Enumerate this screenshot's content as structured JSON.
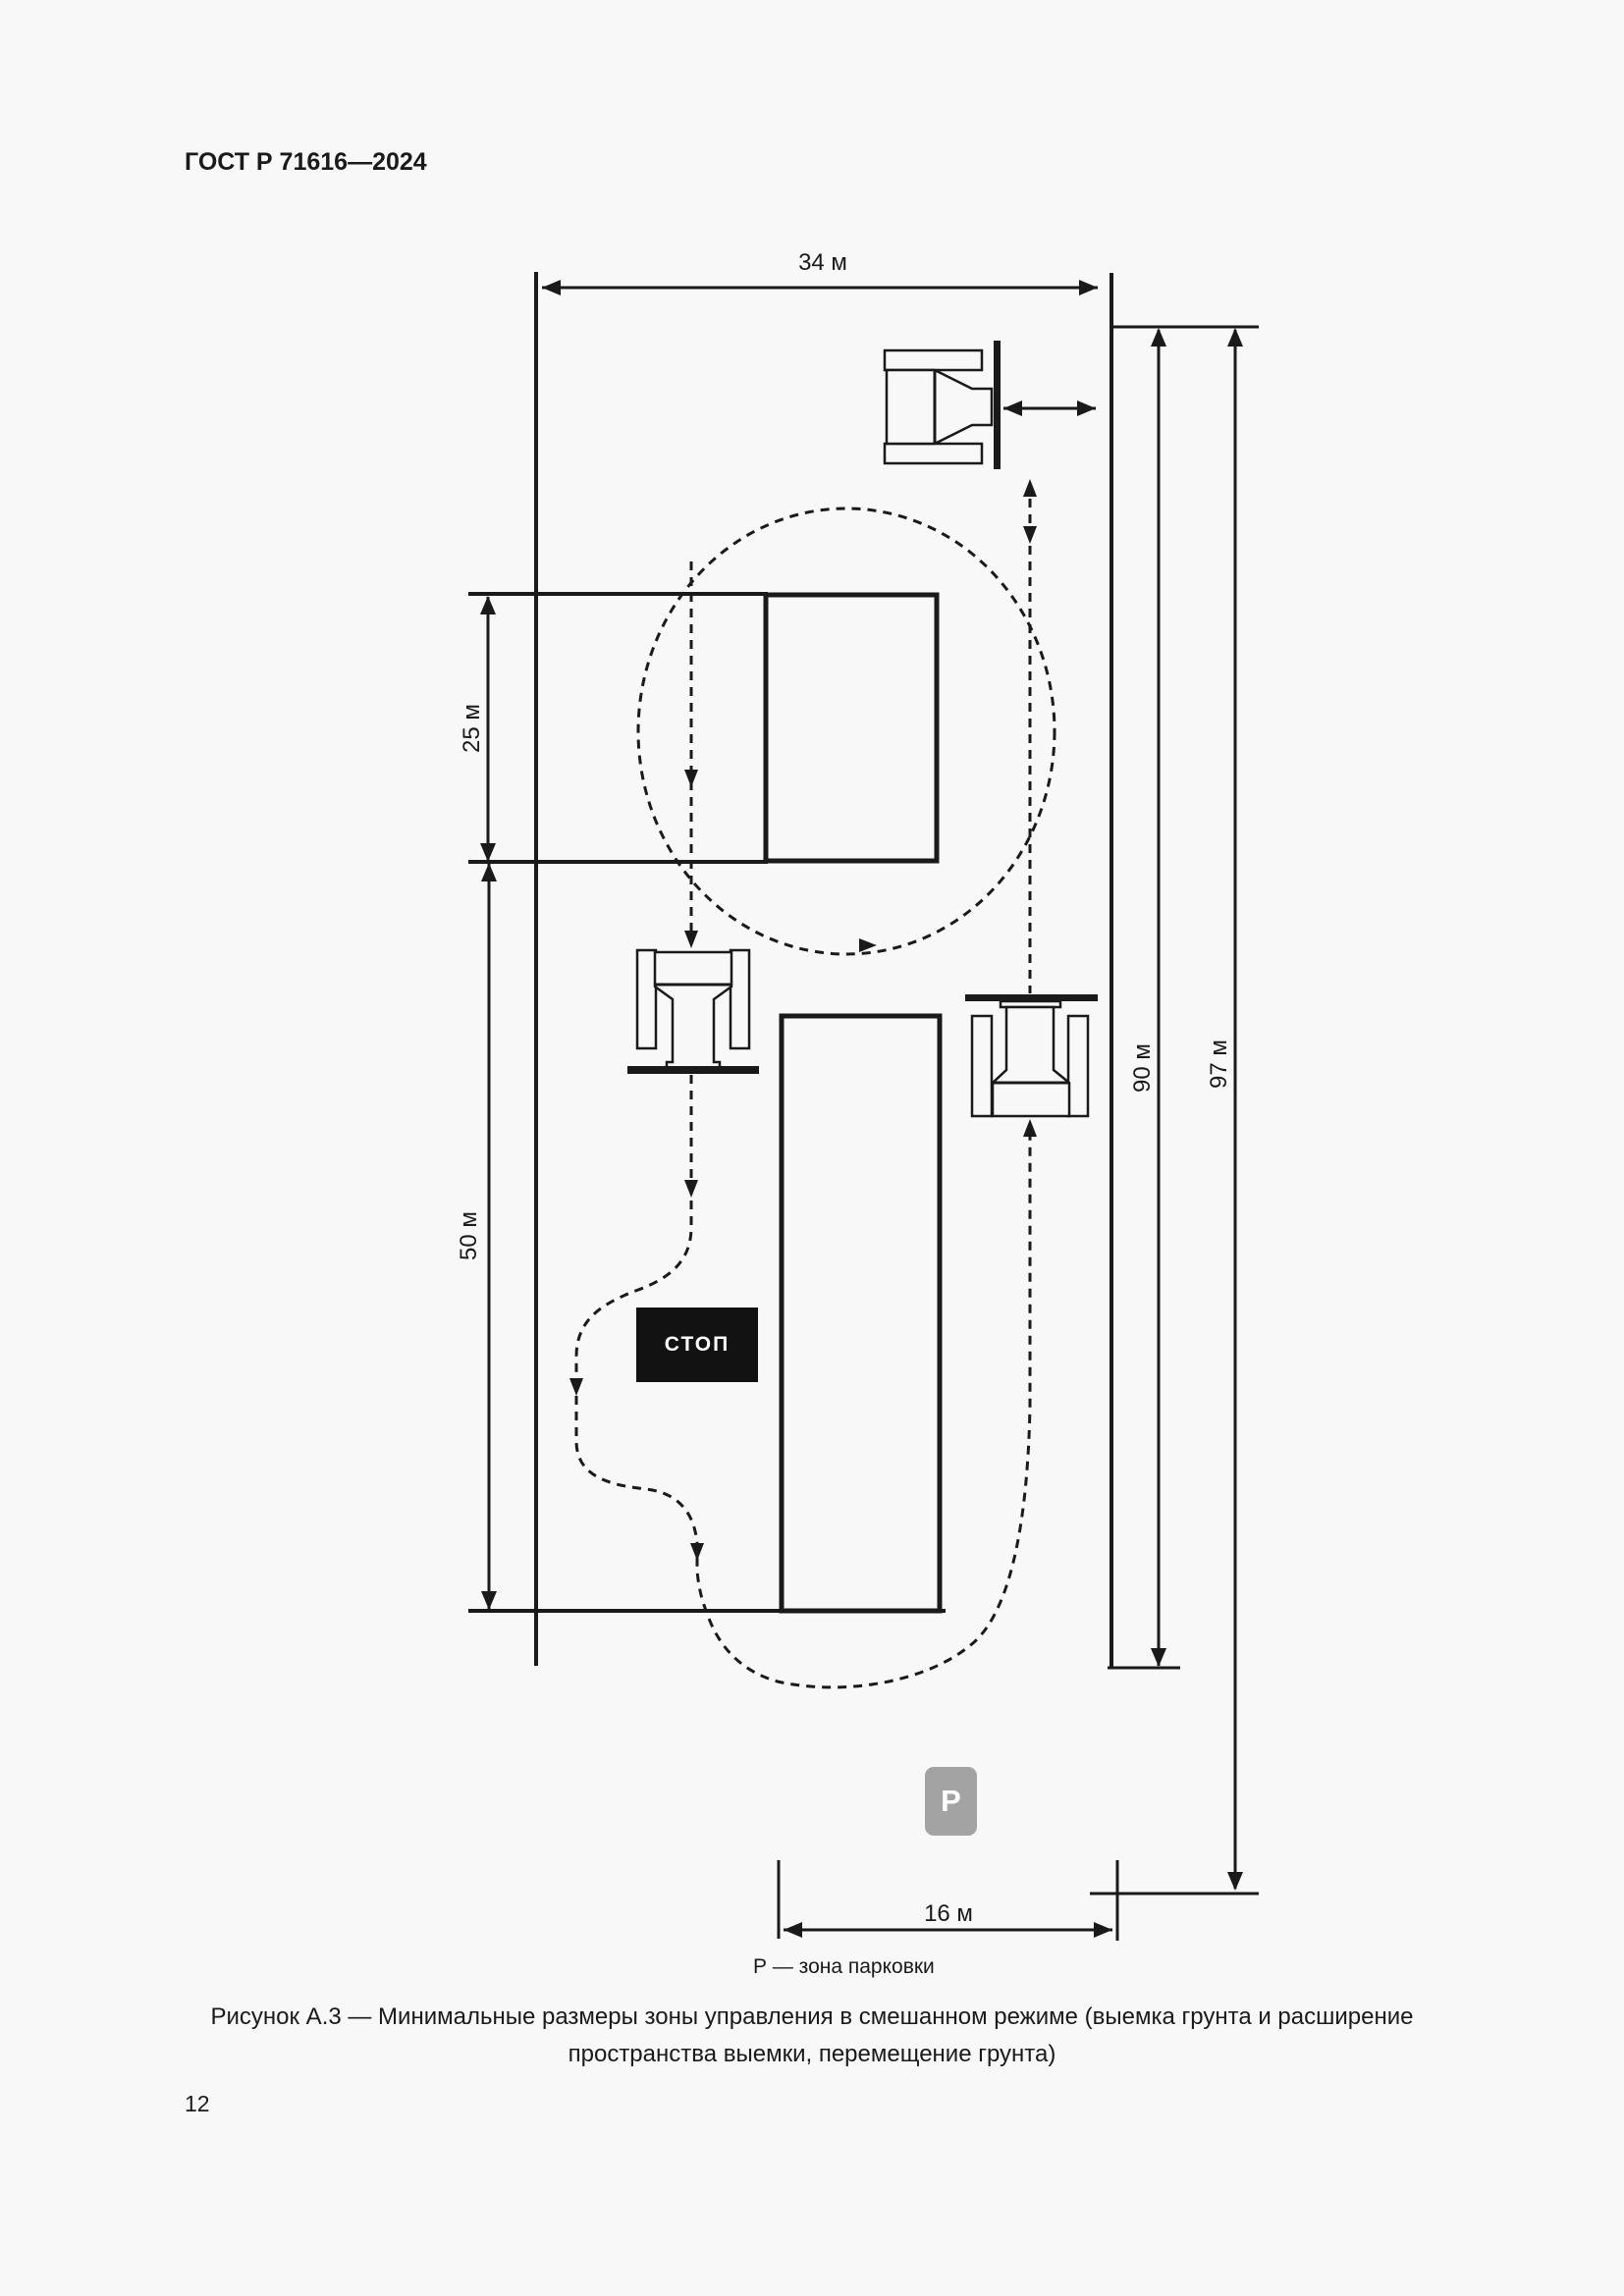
{
  "page": {
    "header": "ГОСТ Р 71616—2024",
    "page_number": "12",
    "figure_caption_line1": "Рисунок А.3 — Минимальные размеры зоны управления в смешанном режиме (выемка грунта и расширение",
    "figure_caption_line2": "пространства выемки, перемещение грунта)",
    "legend": "Р — зона парковки"
  },
  "diagram": {
    "dimensions": {
      "top_width": "34 м",
      "upper_left_height": "25 м",
      "lower_left_height": "50 м",
      "inner_right_height": "90 м",
      "outer_right_height": "97 м",
      "bottom_width": "16 м"
    },
    "stop_sign_label": "СТОП",
    "parking_sign_label": "P",
    "icons": {
      "top_machine": "bulldozer-plan-view-facing-right",
      "middle_machine": "bulldozer-plan-view-facing-down",
      "right_machine": "bulldozer-plan-view-facing-up"
    },
    "colors": {
      "ink": "#1a1a1a",
      "paper": "#f8f8f8",
      "stop_background": "#121212",
      "parking_background": "#a3a3a3"
    }
  }
}
